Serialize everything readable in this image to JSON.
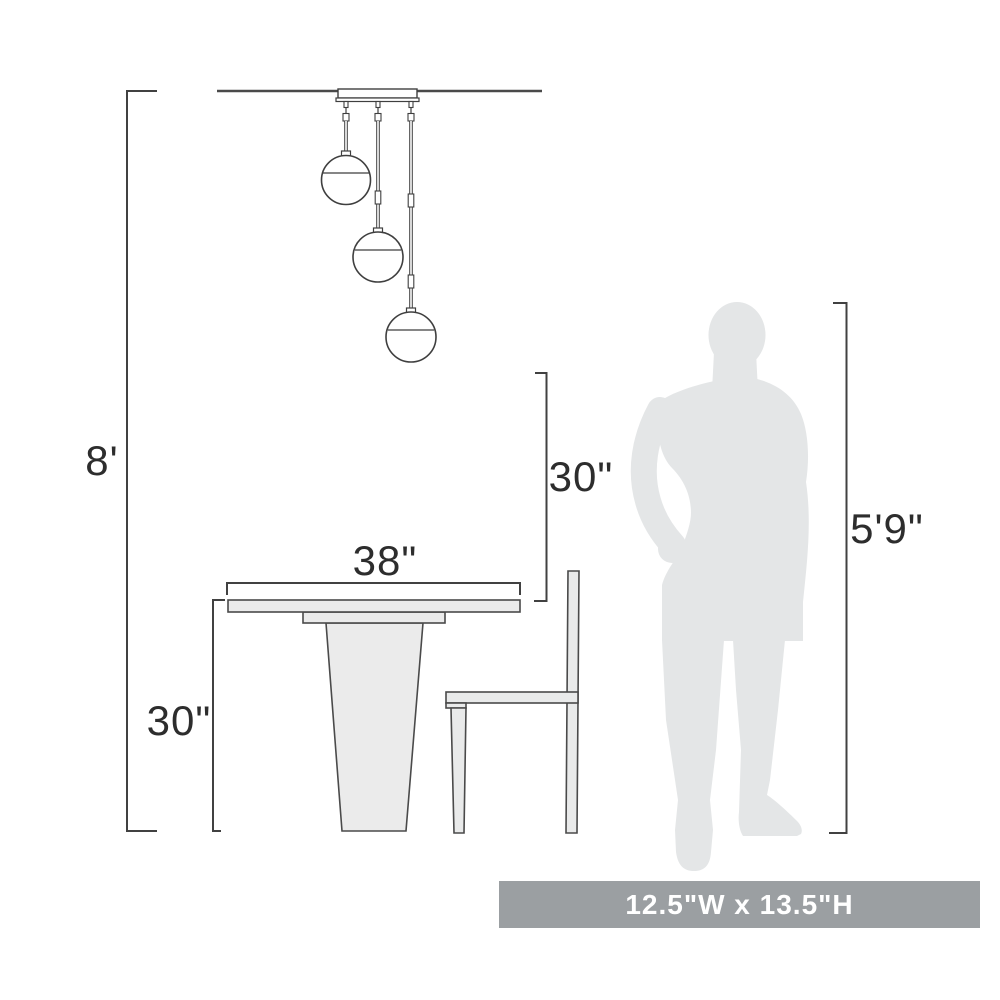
{
  "diagram": {
    "measurements": {
      "ceiling_height": "8'",
      "table_height": "30\"",
      "table_width": "38\"",
      "fixture_bottom_to_table": "30\"",
      "person_height": "5'9\""
    },
    "badge": {
      "text": "12.5\"W x 13.5\"H"
    },
    "colors": {
      "line": "#414141",
      "furniture_fill": "#ebebeb",
      "silhouette_fill": "#e4e6e7",
      "badge_bg": "#9b9fa2",
      "badge_text": "#ffffff",
      "label_text": "#2d2d2d",
      "background": "#ffffff"
    }
  }
}
